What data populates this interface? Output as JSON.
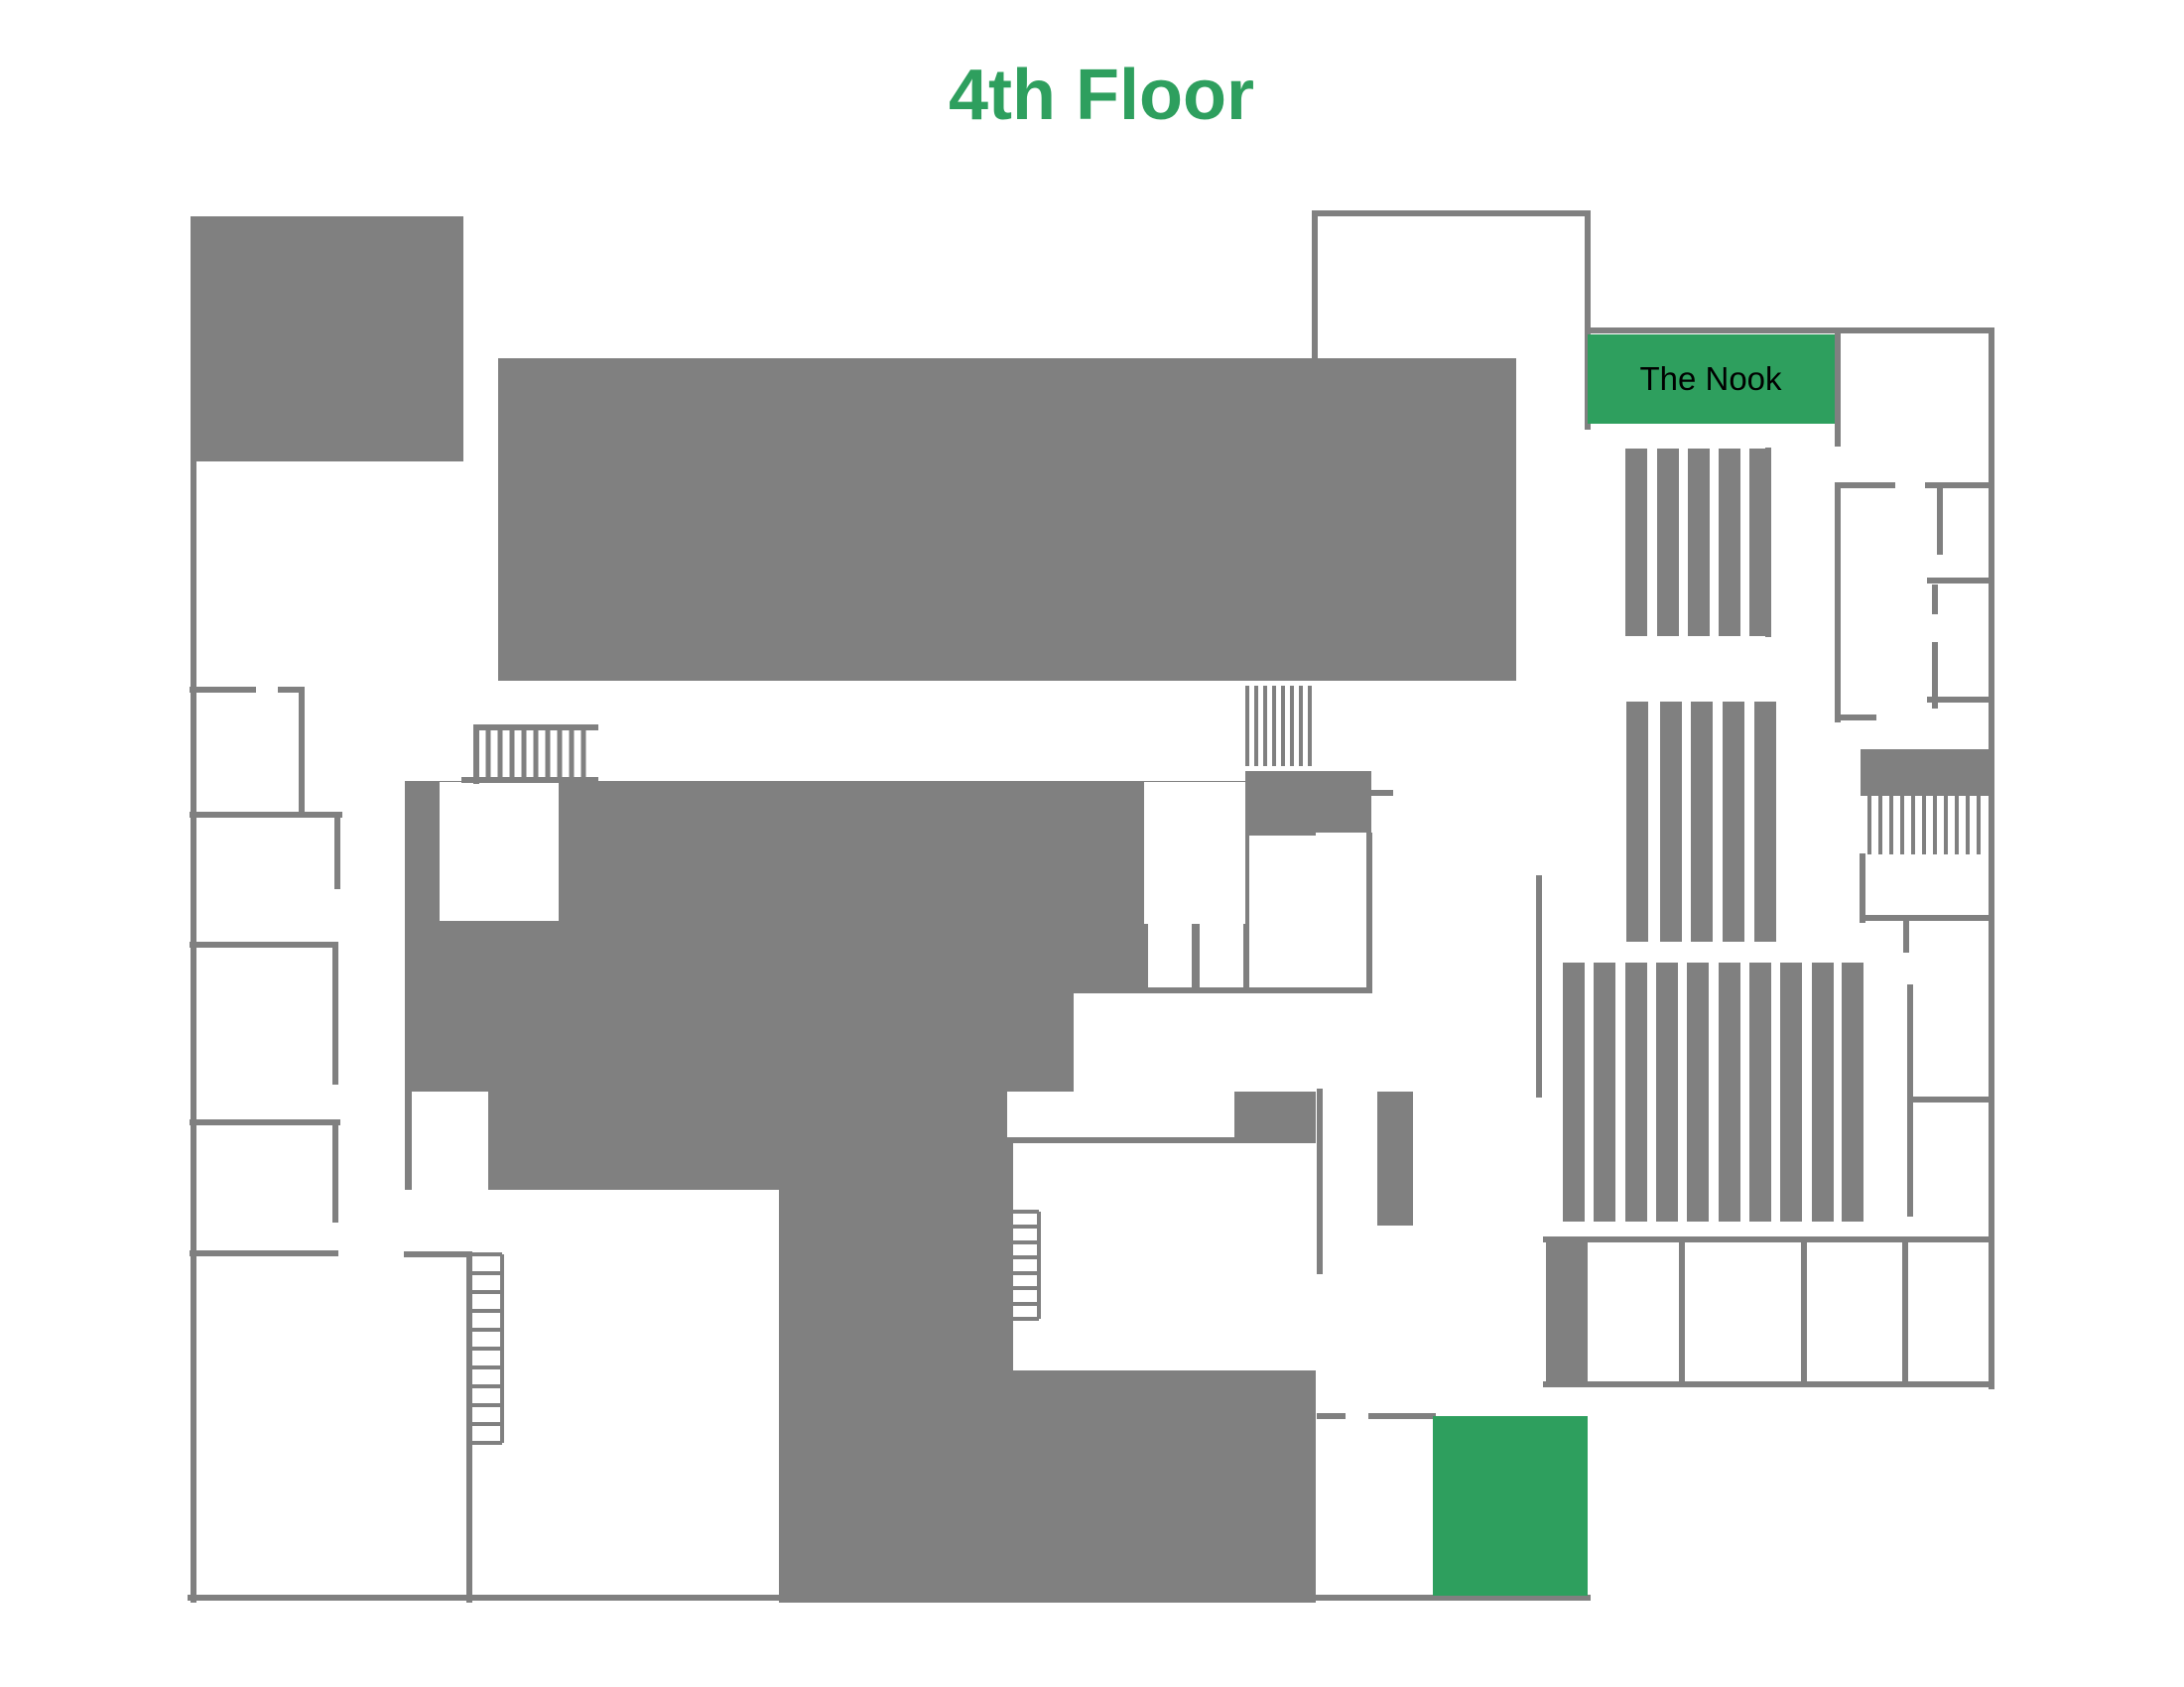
{
  "title": {
    "text": "4th Floor"
  },
  "rooms": {
    "nook": {
      "label": "The Nook",
      "highlighted": true
    },
    "highlight_room": {
      "label": "",
      "highlighted": true
    }
  },
  "colors": {
    "accent_green": "#2e9f5e",
    "floor_gray": "#808080",
    "background": "#ffffff",
    "label_text": "#000000"
  },
  "features": {
    "stack_groups": [
      {
        "name": "stacks-upper-right",
        "bars": 5
      },
      {
        "name": "stacks-middle-right",
        "bars": 5
      },
      {
        "name": "stacks-lower-right",
        "bars": 10
      }
    ],
    "staircases": 3,
    "ladder_stairs": 2
  }
}
